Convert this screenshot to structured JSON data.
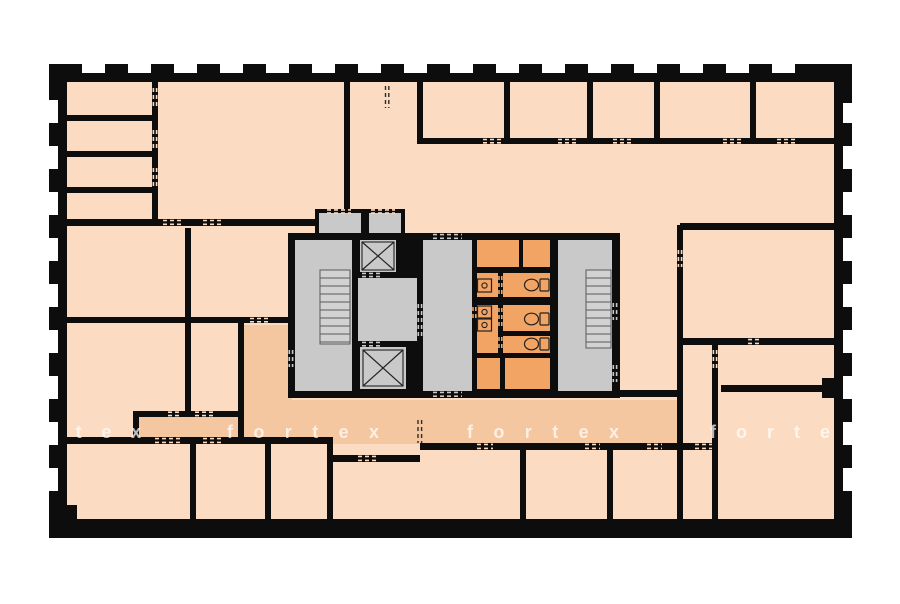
{
  "watermark": {
    "word": "fortex",
    "instances": [
      {
        "text": "rtex"
      },
      {
        "text": "fortex"
      },
      {
        "text": "fortex"
      },
      {
        "text": "forte"
      }
    ]
  },
  "colors": {
    "background": "#ffffff",
    "wall": "#0d0d0d",
    "floor": "#fbdcc2",
    "corridor": "#f5c7a1",
    "wet": "#f1a464",
    "core": "#c9c9c9",
    "stair": "#d2d2d2",
    "tread": "#5a5a5a",
    "fixture": "#222222",
    "window": "#ffffff",
    "dash_dark": "#2b2b2b",
    "watermark": "#ffffff"
  },
  "fixtures": {
    "stairwells": 2,
    "elevator_shafts": 2,
    "toilets": 3,
    "sinks": 3
  }
}
